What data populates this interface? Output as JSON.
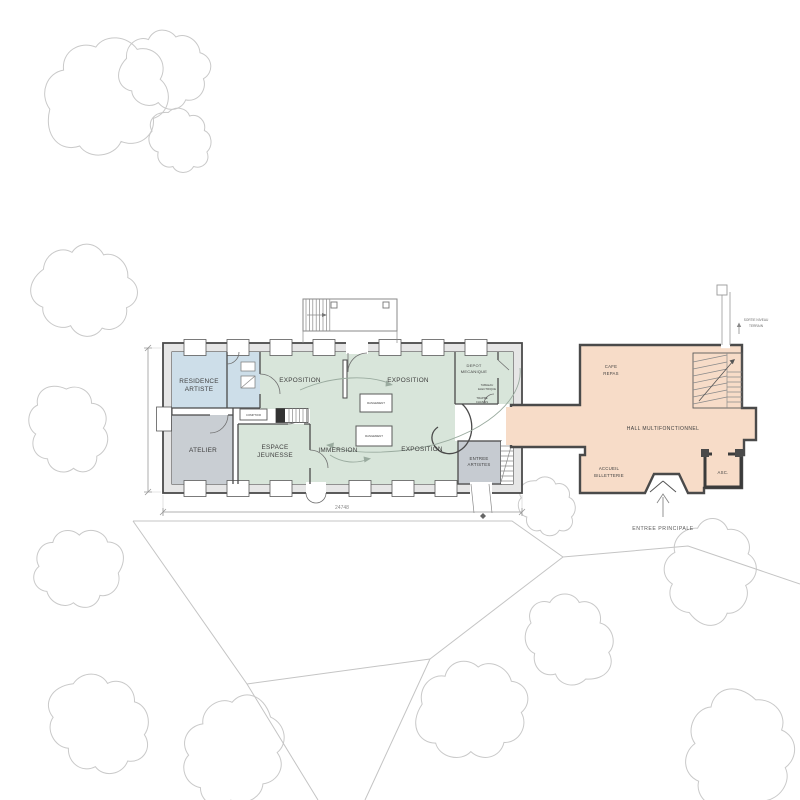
{
  "colors": {
    "exhibition_green": "#d8e5da",
    "residence_blue": "#cddee9",
    "workshop_gray": "#c9ced3",
    "hall_peach": "#f7dcc8",
    "wall": "#4a4a4a",
    "tree_line": "#c9c9c9"
  },
  "plan": {
    "rooms": {
      "residence_artiste_l1": "RESIDENCE",
      "residence_artiste_l2": "ARTISTE",
      "atelier": "ATELIER",
      "espace_jeunesse_l1": "ESPACE",
      "espace_jeunesse_l2": "JEUNESSE",
      "immersion": "IMMERSION",
      "exposition": "EXPOSITION",
      "depot_l1": "DEPOT",
      "depot_l2": "MECANIQUE",
      "tableau_l1": "TABLEAU",
      "tableau_l2": "ELECTRIQUE",
      "trappe_l1": "TRAPPE",
      "trappe_l2": "CHASSIS",
      "rangement": "RANGEMENT",
      "comptoir": "COMPTOIR",
      "entree_artistes_l1": "ENTREE",
      "entree_artistes_l2": "ARTISTES",
      "cafe_l1": "CAFE",
      "cafe_l2": "REPAS",
      "hall": "HALL MULTIFONCTIONNEL",
      "accueil_l1": "ACCUEIL",
      "accueil_l2": "BILLETTERIE",
      "asc": "ASC."
    },
    "annotations": {
      "entree_principale": "ENTREE PRINCIPALE",
      "sortie_l1": "SORTIE  NIVEAU",
      "sortie_l2": "TERRAIN"
    },
    "dimensions": {
      "length": "24748"
    }
  }
}
